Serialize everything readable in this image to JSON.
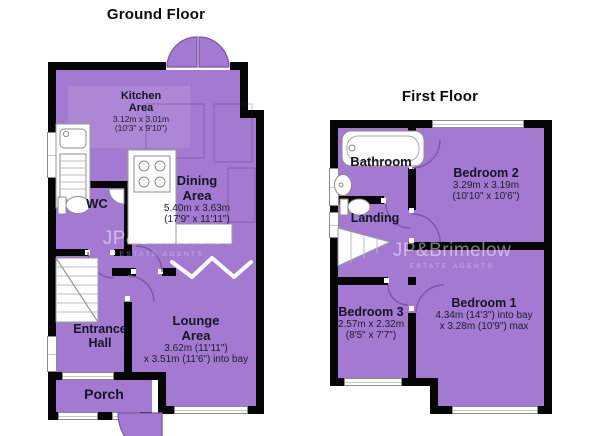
{
  "ground_floor": {
    "title": "Ground Floor",
    "rooms": {
      "kitchen": {
        "name": "Kitchen Area",
        "dims1": "3.12m x 3.01m",
        "dims2": "(10'3\" x 9'10\")"
      },
      "dining": {
        "name": "Dining Area",
        "dims1": "5.40m x 3.63m",
        "dims2": "(17'9\" x 11'11\")"
      },
      "wc": {
        "name": "WC"
      },
      "hall": {
        "name": "Entrance Hall"
      },
      "lounge": {
        "name": "Lounge Area",
        "dims1": "3.62m (11'11\")",
        "dims2": "x 3.51m (11'6\") into bay"
      },
      "porch": {
        "name": "Porch"
      }
    }
  },
  "first_floor": {
    "title": "First Floor",
    "rooms": {
      "bathroom": {
        "name": "Bathroom"
      },
      "bedroom2": {
        "name": "Bedroom 2",
        "dims1": "3.29m x 3.19m",
        "dims2": "(10'10\" x 10'6\")"
      },
      "landing": {
        "name": "Landing"
      },
      "bedroom3": {
        "name": "Bedroom 3",
        "dims1": "2.57m x 2.32m",
        "dims2": "(8'5\" x 7'7\")"
      },
      "bedroom1": {
        "name": "Bedroom 1",
        "dims1": "4.34m (14'3\") into bay",
        "dims2": "x 3.28m (10'9\") max"
      }
    }
  },
  "watermark": {
    "brand": "JP&Brimelow",
    "tagline": "ESTATE AGENTS"
  },
  "colors": {
    "room_fill": "#A479D1",
    "wall": "#060606",
    "window_border": "#8C8C8C",
    "door_stroke": "#7B57A8",
    "text": "#14141E",
    "background": "#FFFFFF"
  }
}
